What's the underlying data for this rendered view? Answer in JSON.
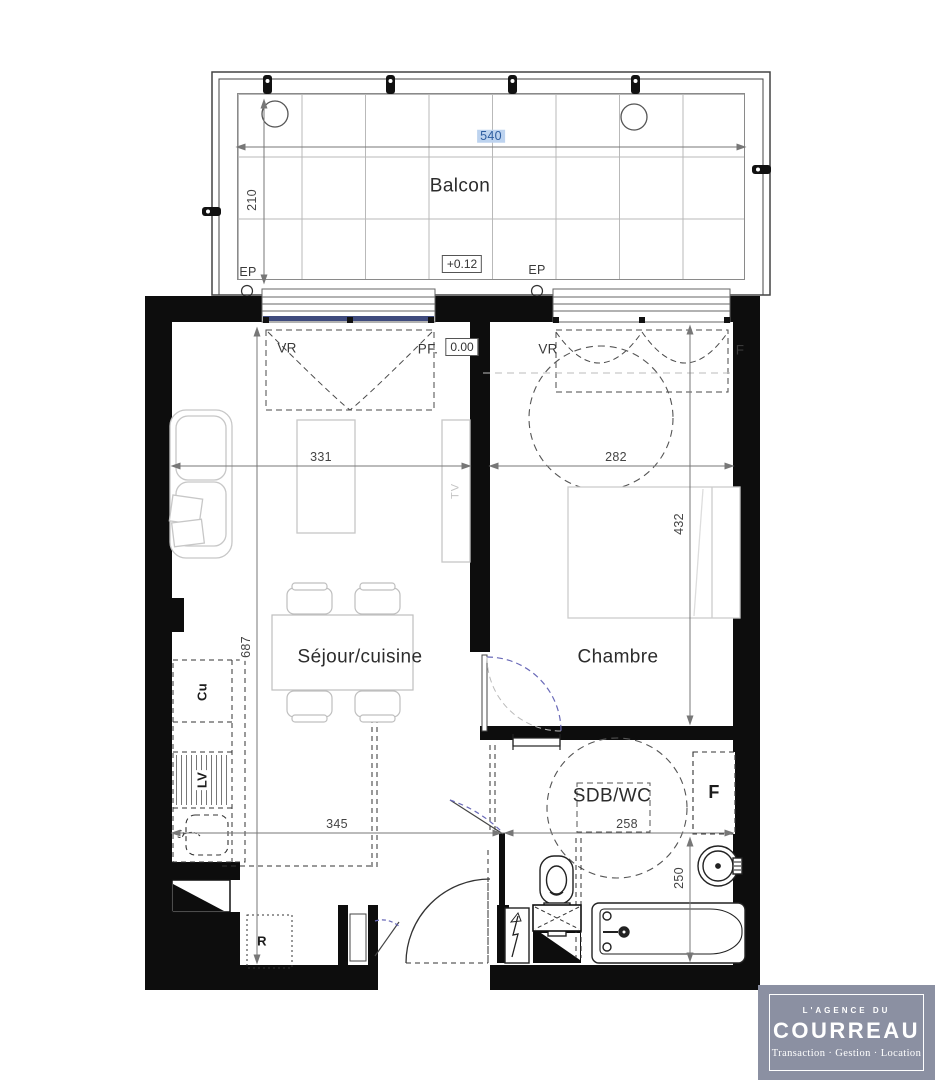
{
  "plan": {
    "rooms": {
      "balcon": "Balcon",
      "sejour": "Séjour/cuisine",
      "chambre": "Chambre",
      "sdb": "SDB/WC"
    },
    "dims": {
      "d540": "540",
      "d210": "210",
      "d331": "331",
      "d282": "282",
      "d432": "432",
      "d687": "687",
      "d345": "345",
      "d258": "258",
      "d250": "250"
    },
    "levels": {
      "balcony": "+0.12",
      "floor": "0.00"
    },
    "ann": {
      "ep": "EP",
      "vr": "VR",
      "pf": "PF.",
      "f_window": "F",
      "cu": "Cu",
      "lv": "LV",
      "r": "R",
      "f_closet": "F",
      "tv": "TV"
    },
    "colors": {
      "wall": "#0d0d0d",
      "dim_highlight_bg": "#bdd3ef",
      "dim_highlight_text": "#2e5d9f",
      "window_sill_blue": "#3f4b7e",
      "door_arc_blue": "#6a6ab8",
      "logo_bg": "#8b90a2"
    }
  },
  "logo": {
    "tagline_top": "L'AGENCE DU",
    "name": "COURREAU",
    "tagline_bottom": "Transaction · Gestion · Location"
  }
}
